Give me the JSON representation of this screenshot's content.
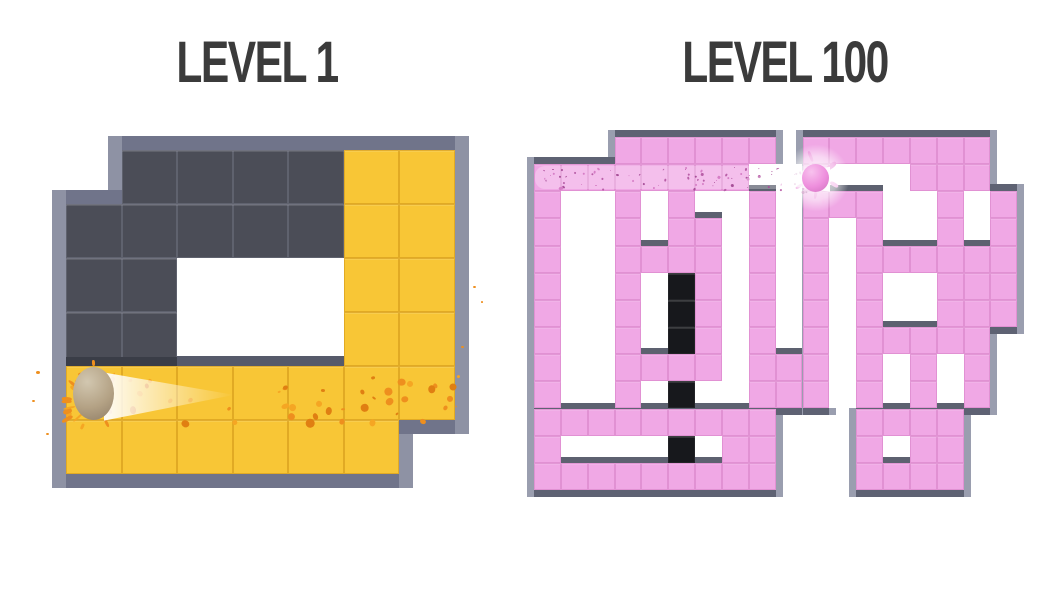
{
  "app": {
    "background": "#ffffff"
  },
  "panels": [
    {
      "id": "level-1",
      "title": "LEVEL 1",
      "title_color": "#3b3b3b",
      "title_box": {
        "left": 57,
        "top": 33,
        "width": 400
      },
      "maze": {
        "x": 66,
        "y": 150,
        "cols": 7,
        "rows": 6,
        "cell_w": 55.5,
        "cell_h": 54,
        "border": 14,
        "border_light": "#8e92a4",
        "border_dark": "#70748a",
        "shelf_color": "#565a6a",
        "shelf_h": 10,
        "dark_shelf_color": "#3a3d47",
        "dark_shelf_h": 9,
        "grid": [
          ".DDDDCC",
          "DDDDDCC",
          "DDWWWCC",
          "DDWWWCC",
          "CCCCCCC",
          "CCCCCC."
        ],
        "palette": {
          "C": {
            "fill": "#f8c636",
            "line": "rgba(202,142,18,0.5)"
          },
          "D": {
            "fill": "#4b4d57",
            "line": "rgba(170,175,195,0.22)"
          }
        },
        "ball": {
          "row": 4,
          "col": 0,
          "w": 41,
          "h": 53,
          "colors": [
            "#d2c7b0",
            "#b4a285",
            "#8f7d66"
          ]
        },
        "trail": {
          "x": 104,
          "y": 368,
          "w": 130,
          "h": 56,
          "dir": "right",
          "clip": "polygon(0% 8%, 100% 48%, 0% 94%)",
          "alpha_near": 0.95,
          "alpha_far": 0.0
        },
        "splatter": {
          "seed": 7,
          "count": 50,
          "x0": 74,
          "x1": 464,
          "y0": 372,
          "y1": 421,
          "min": 2,
          "max": 9,
          "colors": [
            "#ee8f1e",
            "#f5a623",
            "#e07f12"
          ]
        },
        "splash_ring": {
          "seed": 11,
          "count": 16,
          "cx": 94,
          "cy": 396,
          "r0": 22,
          "r1": 36,
          "colors": [
            "#ee8f1e",
            "#f5a623"
          ]
        },
        "stray_dots": [
          {
            "x": 36,
            "y": 371,
            "s": 4
          },
          {
            "x": 32,
            "y": 400,
            "s": 3
          },
          {
            "x": 46,
            "y": 433,
            "s": 3
          },
          {
            "x": 473,
            "y": 286,
            "s": 3
          },
          {
            "x": 481,
            "y": 301,
            "s": 2
          },
          {
            "x": 461,
            "y": 346,
            "s": 3
          }
        ]
      }
    },
    {
      "id": "level-100",
      "title": "LEVEL 100",
      "title_color": "#3b3b3b",
      "title_box": {
        "left": 585,
        "top": 33,
        "width": 400
      },
      "maze": {
        "x": 534,
        "y": 137,
        "cols": 18,
        "rows": 13,
        "cell_w": 26.85,
        "cell_h": 27.15,
        "border": 7,
        "border_light": "#9a9eaf",
        "border_dark": "#5e6273",
        "shelf_color": "#5d6170",
        "shelf_h": 6,
        "dark_shelf_color": "#3a3d47",
        "dark_shelf_h": 6,
        "grid": [
          "...CCCCCC.CCCCCCC.",
          "CCCCCCCCWWCWWWCCC.",
          "CWWCWCWWCWCCCWWCWC",
          "CWWCWCCWCWCWCWWCWC",
          "CWWCCCCWCWCWCCCCCC",
          "CWWCWBCWCWCWCWWCCC",
          "CWWCWBCWCWCWCWWCCC",
          "CWWCWBCWCWCWCCCCC.",
          "CWWCCCCWCCCWCWCWC.",
          "CWWCWBWWCCCWCWCWC.",
          "CCCCCCCCC...CCCC..",
          "CWWWWBWCC...CWCC..",
          "CCCCCCCCC...CCCC.."
        ],
        "palette": {
          "C": {
            "fill": "#f0a8e5",
            "line": "rgba(205,115,185,0.42)"
          },
          "B": {
            "fill": "#17181c",
            "line": "rgba(255,255,255,0.05)"
          }
        },
        "ball": {
          "row": 1,
          "col": 10,
          "w": 27,
          "h": 28,
          "colors": [
            "#f8c2ee",
            "#ee8fdd",
            "#cf6fbe"
          ]
        },
        "trail": {
          "x": 738,
          "y": 163,
          "w": 92,
          "h": 32,
          "dir": "left",
          "clip": "polygon(100% 12%, 0% 50%, 100% 90%)",
          "alpha_near": 0.95,
          "alpha_far": 0.08
        },
        "glow": {
          "cx": 816,
          "cy": 178,
          "r": 34
        },
        "haze": {
          "x": 535,
          "y": 166,
          "w": 278,
          "h": 23,
          "alpha": 0.27
        },
        "splatter": {
          "seed": 3,
          "count": 80,
          "x0": 540,
          "x1": 808,
          "y0": 167,
          "y1": 191,
          "min": 1,
          "max": 3,
          "colors": [
            "#b95fa8",
            "#d67ec6",
            "#a74f98"
          ]
        },
        "splash_ring": {
          "seed": 5,
          "count": 10,
          "cx": 816,
          "cy": 170,
          "r0": 14,
          "r1": 22,
          "colors": [
            "#e87fd4",
            "#f2a3e4"
          ]
        },
        "stray_dots": []
      }
    }
  ]
}
